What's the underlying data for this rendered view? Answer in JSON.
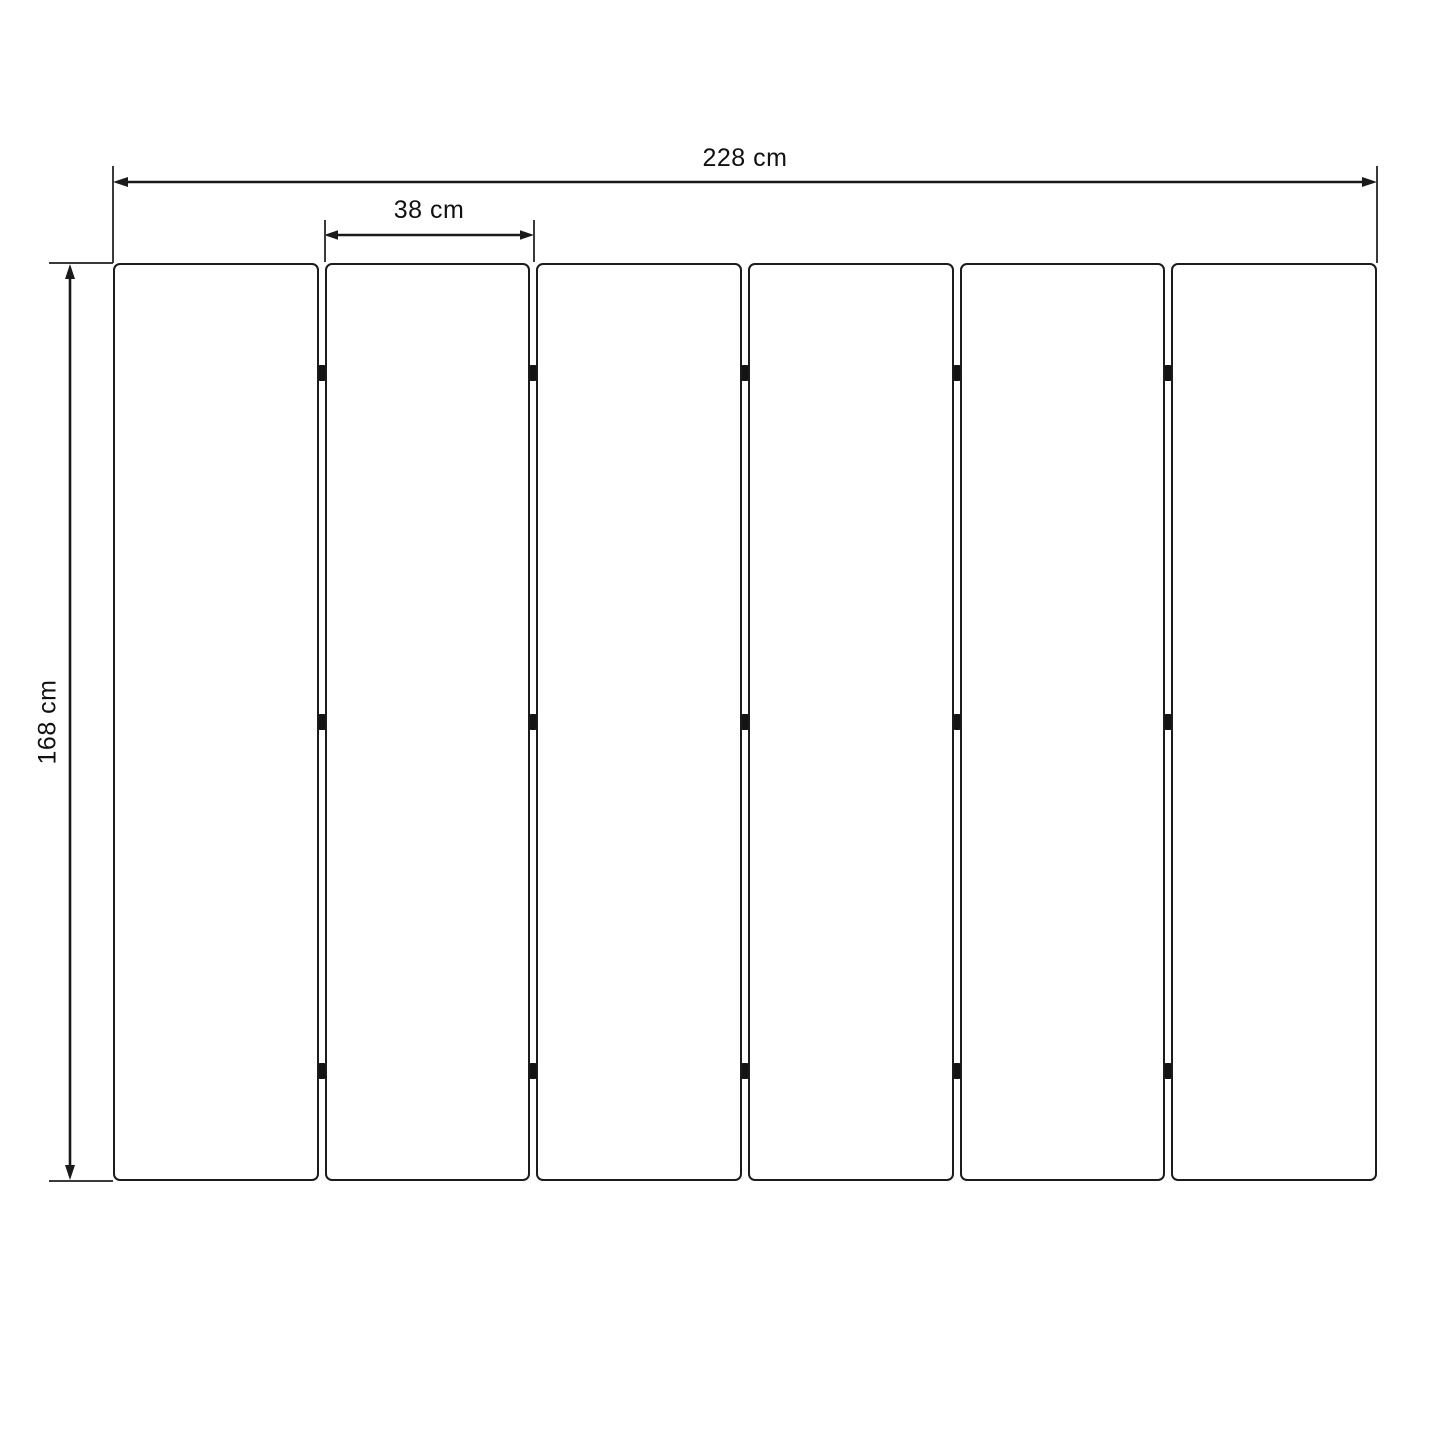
{
  "diagram": {
    "name": "six-panel-divider-dimension-drawing",
    "dimensions": {
      "total_width": {
        "label": "228 cm",
        "value_cm": 228
      },
      "panel_width": {
        "label": "38 cm",
        "value_cm": 38
      },
      "height": {
        "label": "168 cm",
        "value_cm": 168
      }
    },
    "panels": {
      "count": 6
    },
    "connectors": {
      "gap_count": 5,
      "per_gap": 3,
      "positions_pct": [
        12,
        50,
        88
      ]
    },
    "colors": {
      "line": "#1a1a1a",
      "panel_border": "#1c1c1c",
      "extension_line": "#3a3a3a",
      "connector": "#141414",
      "background": "#ffffff",
      "text": "#111111"
    }
  }
}
